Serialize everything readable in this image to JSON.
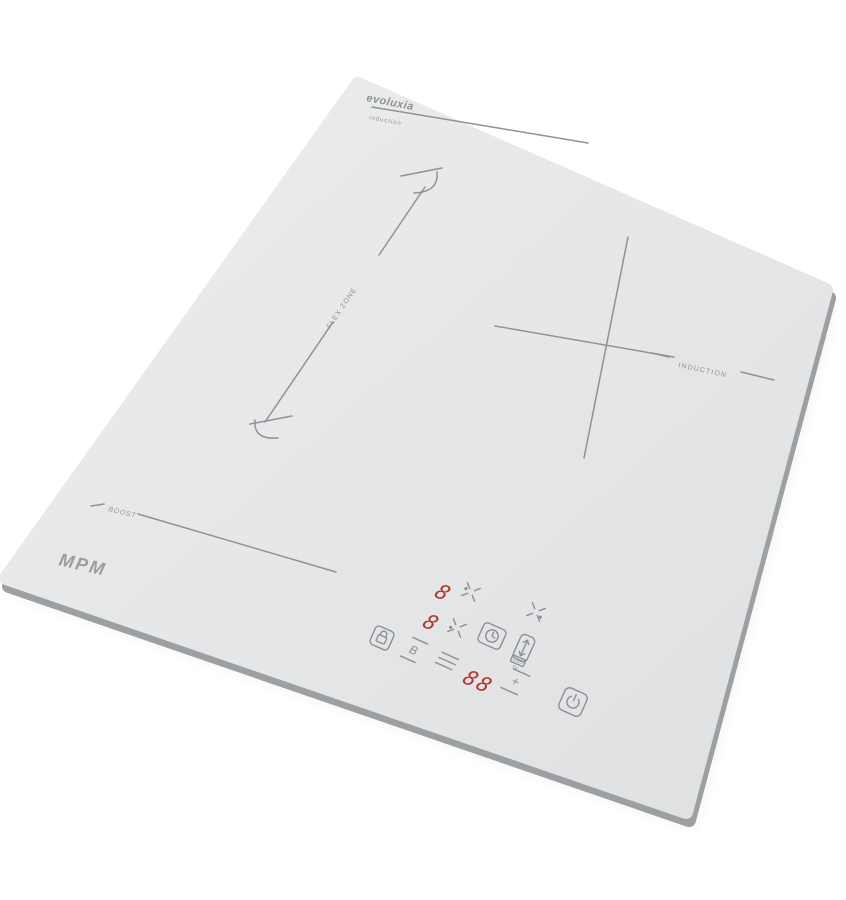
{
  "product": {
    "logo": "MPM",
    "series": "evoluxia",
    "series_subtitle": "induction"
  },
  "surface_markings": {
    "flex_zone_label": "FLEX ZONE",
    "induction_label": "INDUCTION",
    "boost_label": "BOOST"
  },
  "control_panel": {
    "rear_zone_display": "8",
    "front_zone_display": "8",
    "timer_display": "88",
    "boost_key_label": "B",
    "plus_key_label": "+",
    "bridge_key_caption_top": "OSD",
    "bridge_key_caption_bottom": "TK"
  },
  "colors": {
    "surface": "#e6e7e8",
    "edge": "#9da0a2",
    "markings": "#8f9295",
    "display_red": "#b2392e",
    "background": "#ffffff"
  }
}
